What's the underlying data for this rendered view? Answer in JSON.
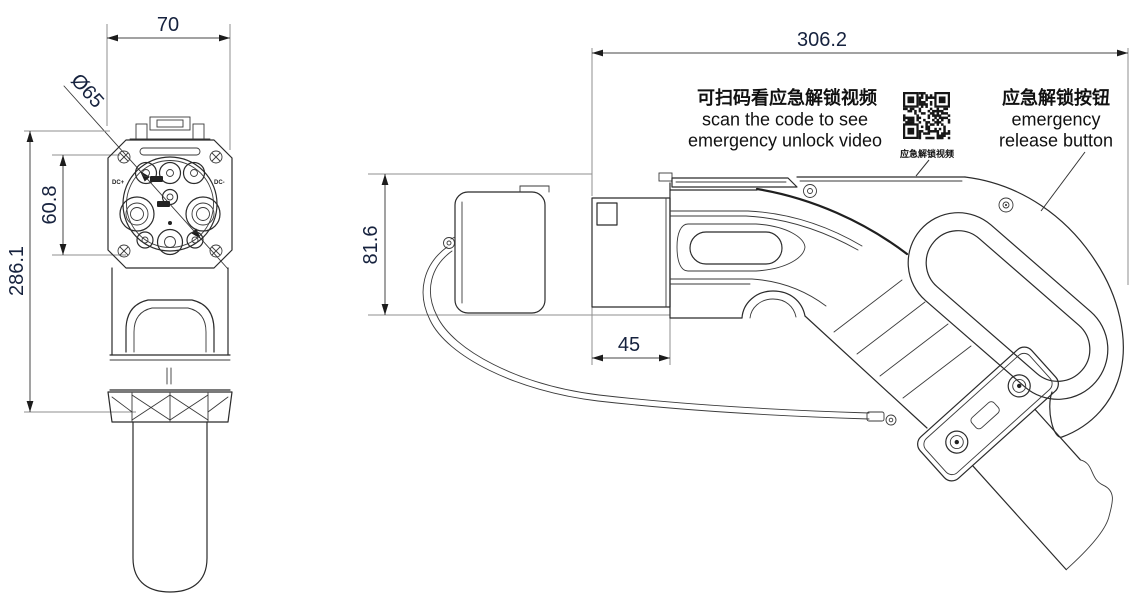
{
  "page": {
    "background": "#ffffff"
  },
  "colors": {
    "drawing_line": "#2b2b2b",
    "extension_line": "#8f8f8f",
    "dimension_text": "#16223e",
    "annotation_text": "#111111"
  },
  "front_view": {
    "dim_width": "70",
    "dim_diameter": "Ø65",
    "dim_pin_span": "60.8",
    "dim_total_height": "286.1",
    "label_dc_plus": "DC+",
    "label_dc_minus": "DC-"
  },
  "side_view": {
    "dim_total_length": "306.2",
    "dim_body_height": "81.6",
    "dim_nozzle_length": "45",
    "qr_note_line1": "可扫码看应急解锁视频",
    "qr_note_line2": "scan the code to see",
    "qr_note_line3": "emergency unlock video",
    "qr_caption": "应急解锁视频",
    "button_note_line1": "应急解锁按钮",
    "button_note_line2": "emergency",
    "button_note_line3": "release button"
  }
}
